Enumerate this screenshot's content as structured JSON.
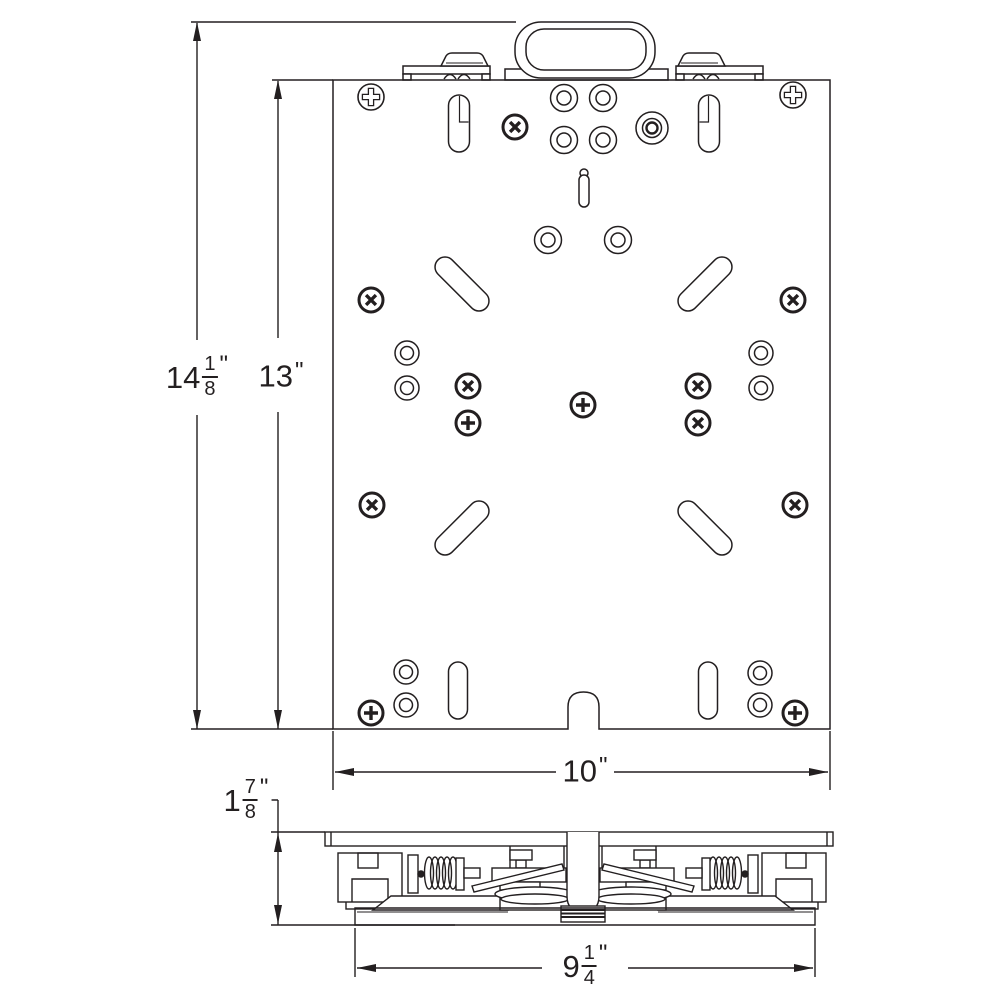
{
  "page": {
    "background": "#ffffff",
    "line_color": "#231f20"
  },
  "dimensions": {
    "overall_height": {
      "display": "14 1/8\"",
      "whole": "14",
      "num": "1",
      "den": "8",
      "unit": "\""
    },
    "plate_height": {
      "display": "13\"",
      "whole": "13",
      "unit": "\""
    },
    "plate_width": {
      "display": "10\"",
      "whole": "10",
      "unit": "\""
    },
    "profile_height": {
      "display": "1 7/8\"",
      "whole": "1",
      "num": "7",
      "den": "8",
      "unit": "\""
    },
    "base_width": {
      "display": "9 1/4\"",
      "whole": "9",
      "num": "1",
      "den": "4",
      "unit": "\""
    }
  }
}
